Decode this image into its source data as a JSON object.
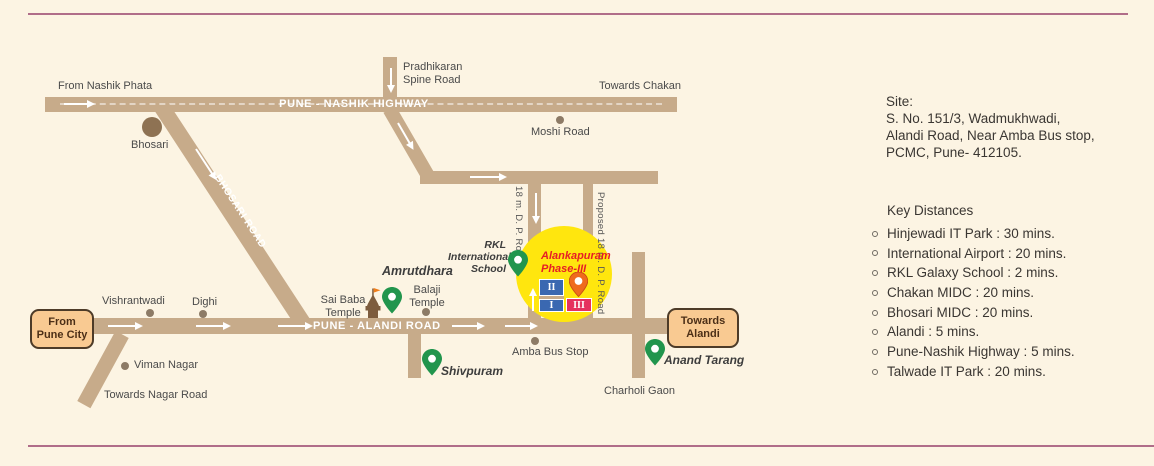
{
  "page": {
    "background_color": "#fcf4e3",
    "accent_line_color": "#b06d89"
  },
  "map": {
    "road_color": "#c7ab8a",
    "highlight_color": "#ffe60e",
    "pin_color": "#21954d",
    "roads": {
      "pune_nashik_highway": "PUNE - NASHIK HIGHWAY",
      "bhosari_road": "BHOSARI ROAD",
      "pune_alandi_road": "PUNE - ALANDI ROAD",
      "dp_road_18m": "18 m. D. P. Road",
      "proposed_dp_road": "Proposed 18 m. D. P. Road"
    },
    "labels": {
      "from_nashik_phata": "From Nashik Phata",
      "pradhikaran_line1": "Pradhikaran",
      "pradhikaran_line2": "Spine Road",
      "towards_chakan": "Towards Chakan",
      "moshi_road": "Moshi Road",
      "bhosari": "Bhosari",
      "vishrantwadi": "Vishrantwadi",
      "dighi": "Dighi",
      "viman_nagar": "Viman Nagar",
      "towards_nagar_road": "Towards Nagar Road",
      "sai_baba_line1": "Sai Baba",
      "sai_baba_line2": "Temple",
      "balaji_line1": "Balaji",
      "balaji_line2": "Temple",
      "amba_bus_stop": "Amba Bus Stop",
      "charholi_gaon": "Charholi Gaon"
    },
    "landmarks": {
      "amrutdhara": "Amrutdhara",
      "rkl_line1": "RKL",
      "rkl_line2": "International",
      "rkl_line3": "School",
      "shivpuram": "Shivpuram",
      "anand_tarang": "Anand Tarang"
    },
    "direction_boxes": {
      "from_pune_city_line1": "From",
      "from_pune_city_line2": "Pune City",
      "towards_alandi_line1": "Towards",
      "towards_alandi_line2": "Alandi"
    },
    "site_marker": {
      "name_line1": "Alankapuram",
      "name_line2": "Phase-III",
      "name_color": "#e61e25",
      "phase_2": "II",
      "phase_1": "I",
      "phase_3": "III",
      "phase12_color": "#3a68b1",
      "phase3_color": "#e5315e",
      "pin_color": "#ef6b1d"
    }
  },
  "sidebar": {
    "site": {
      "title": "Site:",
      "address_line1": "S. No. 151/3, Wadmukhwadi,",
      "address_line2": "Alandi Road, Near Amba Bus stop,",
      "address_line3": "PCMC, Pune- 412105."
    },
    "key_distances": {
      "title": "Key Distances",
      "items": [
        "Hinjewadi IT Park : 30 mins.",
        "International Airport : 20 mins.",
        "RKL Galaxy School : 2 mins.",
        "Chakan MIDC : 20 mins.",
        "Bhosari MIDC : 20 mins.",
        "Alandi : 5 mins.",
        "Pune-Nashik Highway : 5 mins.",
        "Talwade IT Park : 20 mins."
      ]
    }
  }
}
